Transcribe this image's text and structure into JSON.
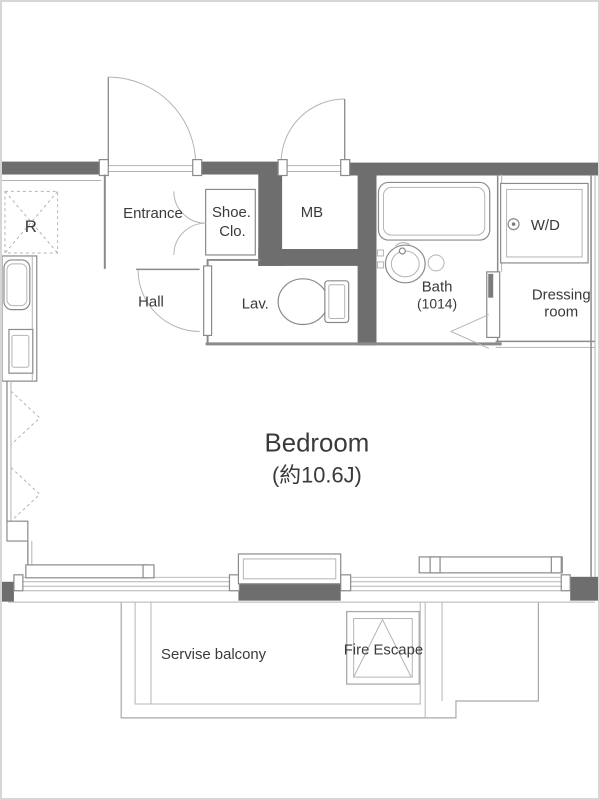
{
  "colors": {
    "bg": "#ffffff",
    "frame_border": "#d6d6d6",
    "wall": "#6e6e6e",
    "line": "#8a8a8a",
    "line_light": "#b4b4b4",
    "balcony_line": "#a9a9a9",
    "text": "#3a3a3a"
  },
  "plan": {
    "labels": {
      "r": "R",
      "entrance": "Entrance",
      "shoe_line1": "Shoe.",
      "shoe_line2": "Clo.",
      "mb": "MB",
      "hall": "Hall",
      "lav": "Lav.",
      "bath": "Bath",
      "bath_size": "(1014)",
      "wd": "W/D",
      "dressing_line1": "Dressing",
      "dressing_line2": "room",
      "bedroom": "Bedroom",
      "bedroom_size": "(約10.6J)",
      "service_balcony": "Servise balcony",
      "fire_escape": "Fire Escape"
    }
  }
}
